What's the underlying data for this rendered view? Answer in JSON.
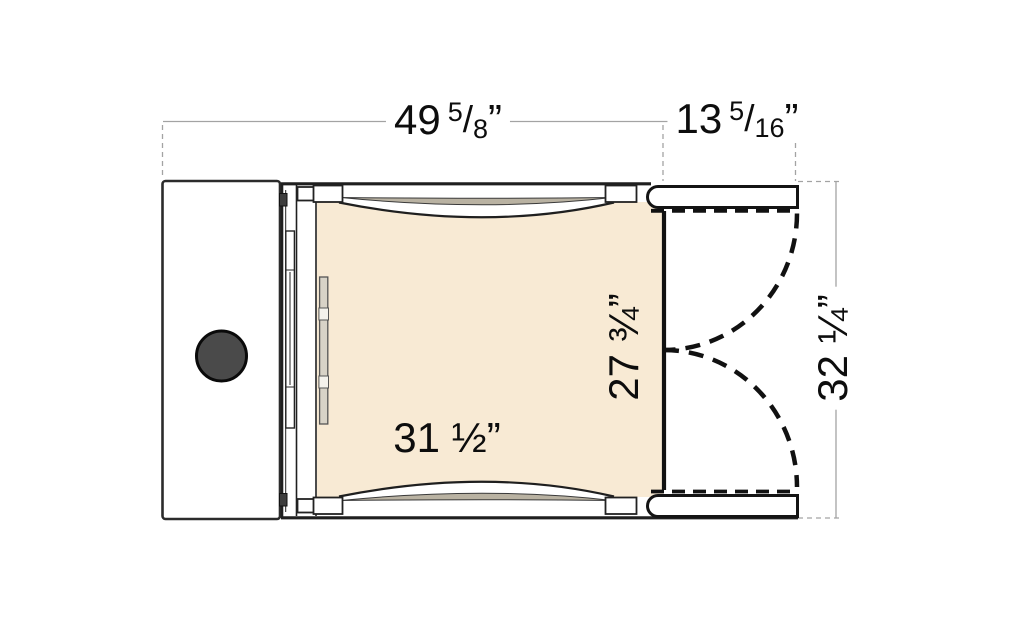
{
  "figure": {
    "description": "Plan-view dimension drawing of a fold-out sofa / dinette seat with side table",
    "background": "#ffffff"
  },
  "dims": {
    "overall_width": {
      "whole": "49",
      "num": "5",
      "den": "8",
      "unit": "”"
    },
    "extension_width": {
      "whole": "13",
      "num": "5",
      "den": "16",
      "unit": "”"
    },
    "seat_width": {
      "text": "31 ½”"
    },
    "seat_depth": {
      "text": "27 ¾”"
    },
    "overall_depth": {
      "text": "32 ¼”"
    }
  },
  "colors": {
    "background": "#ffffff",
    "structure_line": "#1f1f1f",
    "dimension_line": "#a3a3a3",
    "cushion": "#f8ead4",
    "bolster_shadow": "#b9b2a2",
    "knob": "#4a4a4a",
    "hinge_block": "#3c3c3c",
    "strip_fill": "#d8d3c7"
  }
}
